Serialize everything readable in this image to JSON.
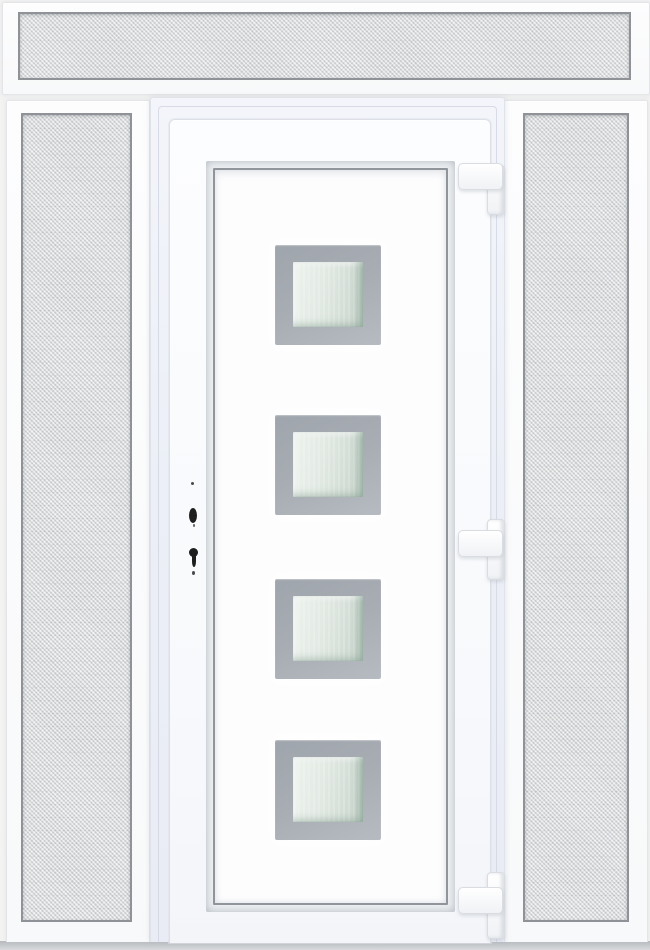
{
  "scene": {
    "type": "product-photo",
    "description": "White uPVC front entry door with four square frosted glazing panels framed in silver-grey, flanked by two frosted textured-glass sidelights and a frosted textured-glass transom window above; three white hinges on the right edge and lock/keyhole cut-outs on the left edge",
    "background_color": "#f3f4f2"
  },
  "colors": {
    "background": "#f3f4f2",
    "frame-white": "#fbfcfd",
    "door-frame-tint": "#e9ecf5",
    "leaf-white": "#fafbfd",
    "glass-border": "#8f9397",
    "privacy-glass": "#dcdee0",
    "panel-outline": "#8f959b",
    "glazing-frame": "#a8adb4",
    "glazing-glass": "#dce4de",
    "hardware-dark": "#1e1e1e",
    "bottom-shadow": "#c6c9cb"
  },
  "unit": {
    "transom": {
      "position": "top",
      "glazing": "frosted textured glass",
      "frame": "white"
    },
    "left_sidelight": {
      "position": "left",
      "glazing": "frosted textured glass",
      "frame": "white"
    },
    "right_sidelight": {
      "position": "right",
      "glazing": "frosted textured glass",
      "frame": "white"
    },
    "door": {
      "leaf_color": "white",
      "glazing_panels": {
        "count": 4,
        "shape": "square",
        "frame_finish": "silver-grey",
        "glass": "frosted",
        "arrangement": "vertical column, centered"
      },
      "hinges": {
        "count": 3,
        "side": "right",
        "color": "white"
      },
      "hardware": {
        "side": "left",
        "items": [
          "screw-dot",
          "handle-spindle-hole",
          "screw-dot",
          "keyhole",
          "screw-dot"
        ]
      }
    }
  }
}
